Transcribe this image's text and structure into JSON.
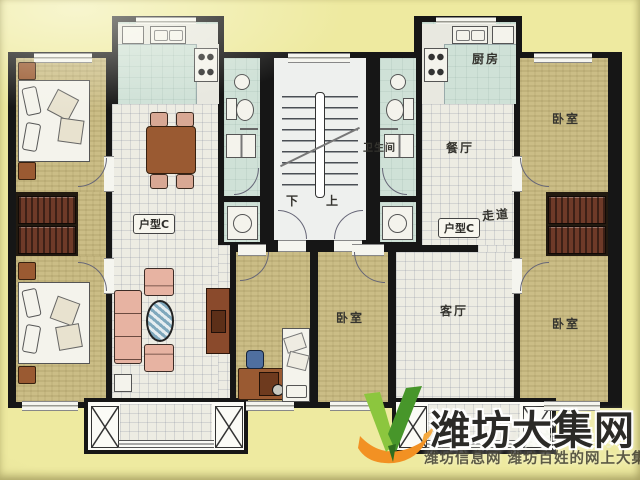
{
  "plan": {
    "unit_left": {
      "type_label": "户型C"
    },
    "unit_right": {
      "type_label": "户型C",
      "kitchen": "厨房",
      "bathroom": "卫生间",
      "dining": "餐厅",
      "corridor": "走道",
      "living": "客厅",
      "bedroom_ne": "卧室",
      "bedroom_se": "卧室",
      "bedroom_sw": "卧室"
    },
    "stairwell": {
      "down": "下",
      "up": "上"
    }
  },
  "watermark": {
    "site": "潍坊大集网",
    "ghost": "潍坊大集网",
    "tagline": "潍坊信息网 潍坊百姓的网上大集"
  },
  "colors": {
    "background": "#eeeaa0",
    "wall": "#161616",
    "bedroom_floor": "#cbbd86",
    "wet_floor": "#cfe1d7",
    "hall_floor": "#edece3",
    "furniture_brown": "#9a5a32",
    "wardrobe": "#6e3a28",
    "sofa_pink": "#e7b3a2",
    "logo_green": "#6ab32f",
    "logo_orange": "#f29123",
    "title_text": "#2b2a27"
  }
}
